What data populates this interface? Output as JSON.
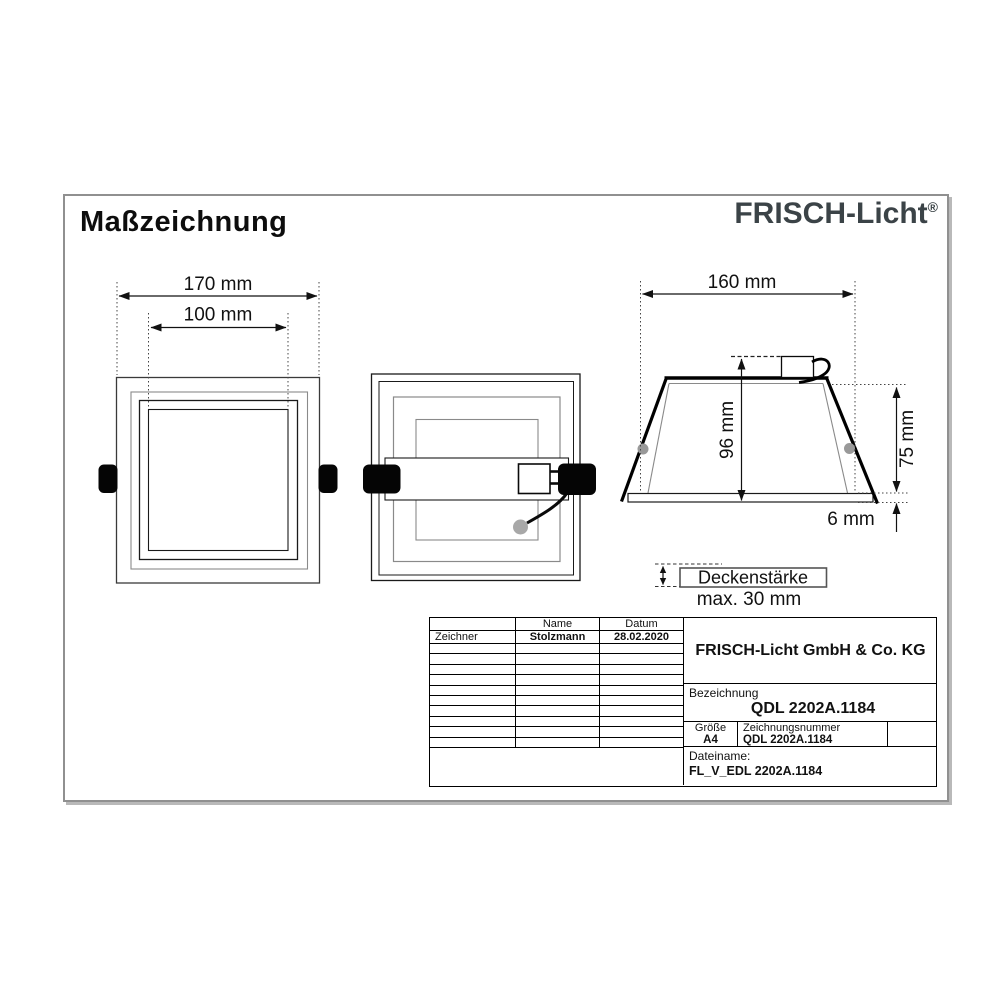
{
  "page": {
    "title": "Maßzeichnung",
    "brand": "FRISCH-Licht",
    "registered_mark": "®"
  },
  "colors": {
    "brand_text": "#3b4347",
    "line_black": "#1a1a1a",
    "line_gray": "#8a8a8a",
    "page_border": "#909090",
    "clip_fill": "#050505",
    "pivot_gray": "#999999"
  },
  "front_view": {
    "outer_width_dim": "170 mm",
    "cutout_dim": "100 mm"
  },
  "side_view": {
    "width_dim": "160 mm",
    "height_dim": "96 mm",
    "recess_depth_dim": "75 mm",
    "flange_dim": "6 mm"
  },
  "ceiling_note": {
    "boxed_label": "Deckenstärke",
    "max_value": "max. 30 mm"
  },
  "title_block": {
    "header": {
      "name": "Name",
      "datum": "Datum"
    },
    "rows": [
      {
        "role": "Zeichner",
        "name": "Stolzmann",
        "datum": "28.02.2020"
      }
    ],
    "company": "FRISCH-Licht GmbH & Co. KG",
    "bezeichnung_label": "Bezeichnung",
    "bezeichnung_value": "QDL 2202A.1184",
    "groesse_label": "Größe",
    "groesse_value": "A4",
    "zeichnungsnummer_label": "Zeichnungsnummer",
    "zeichnungsnummer_value": "QDL 2202A.1184",
    "dateiname_label": "Dateiname:",
    "dateiname_value": "FL_V_EDL 2202A.1184"
  }
}
